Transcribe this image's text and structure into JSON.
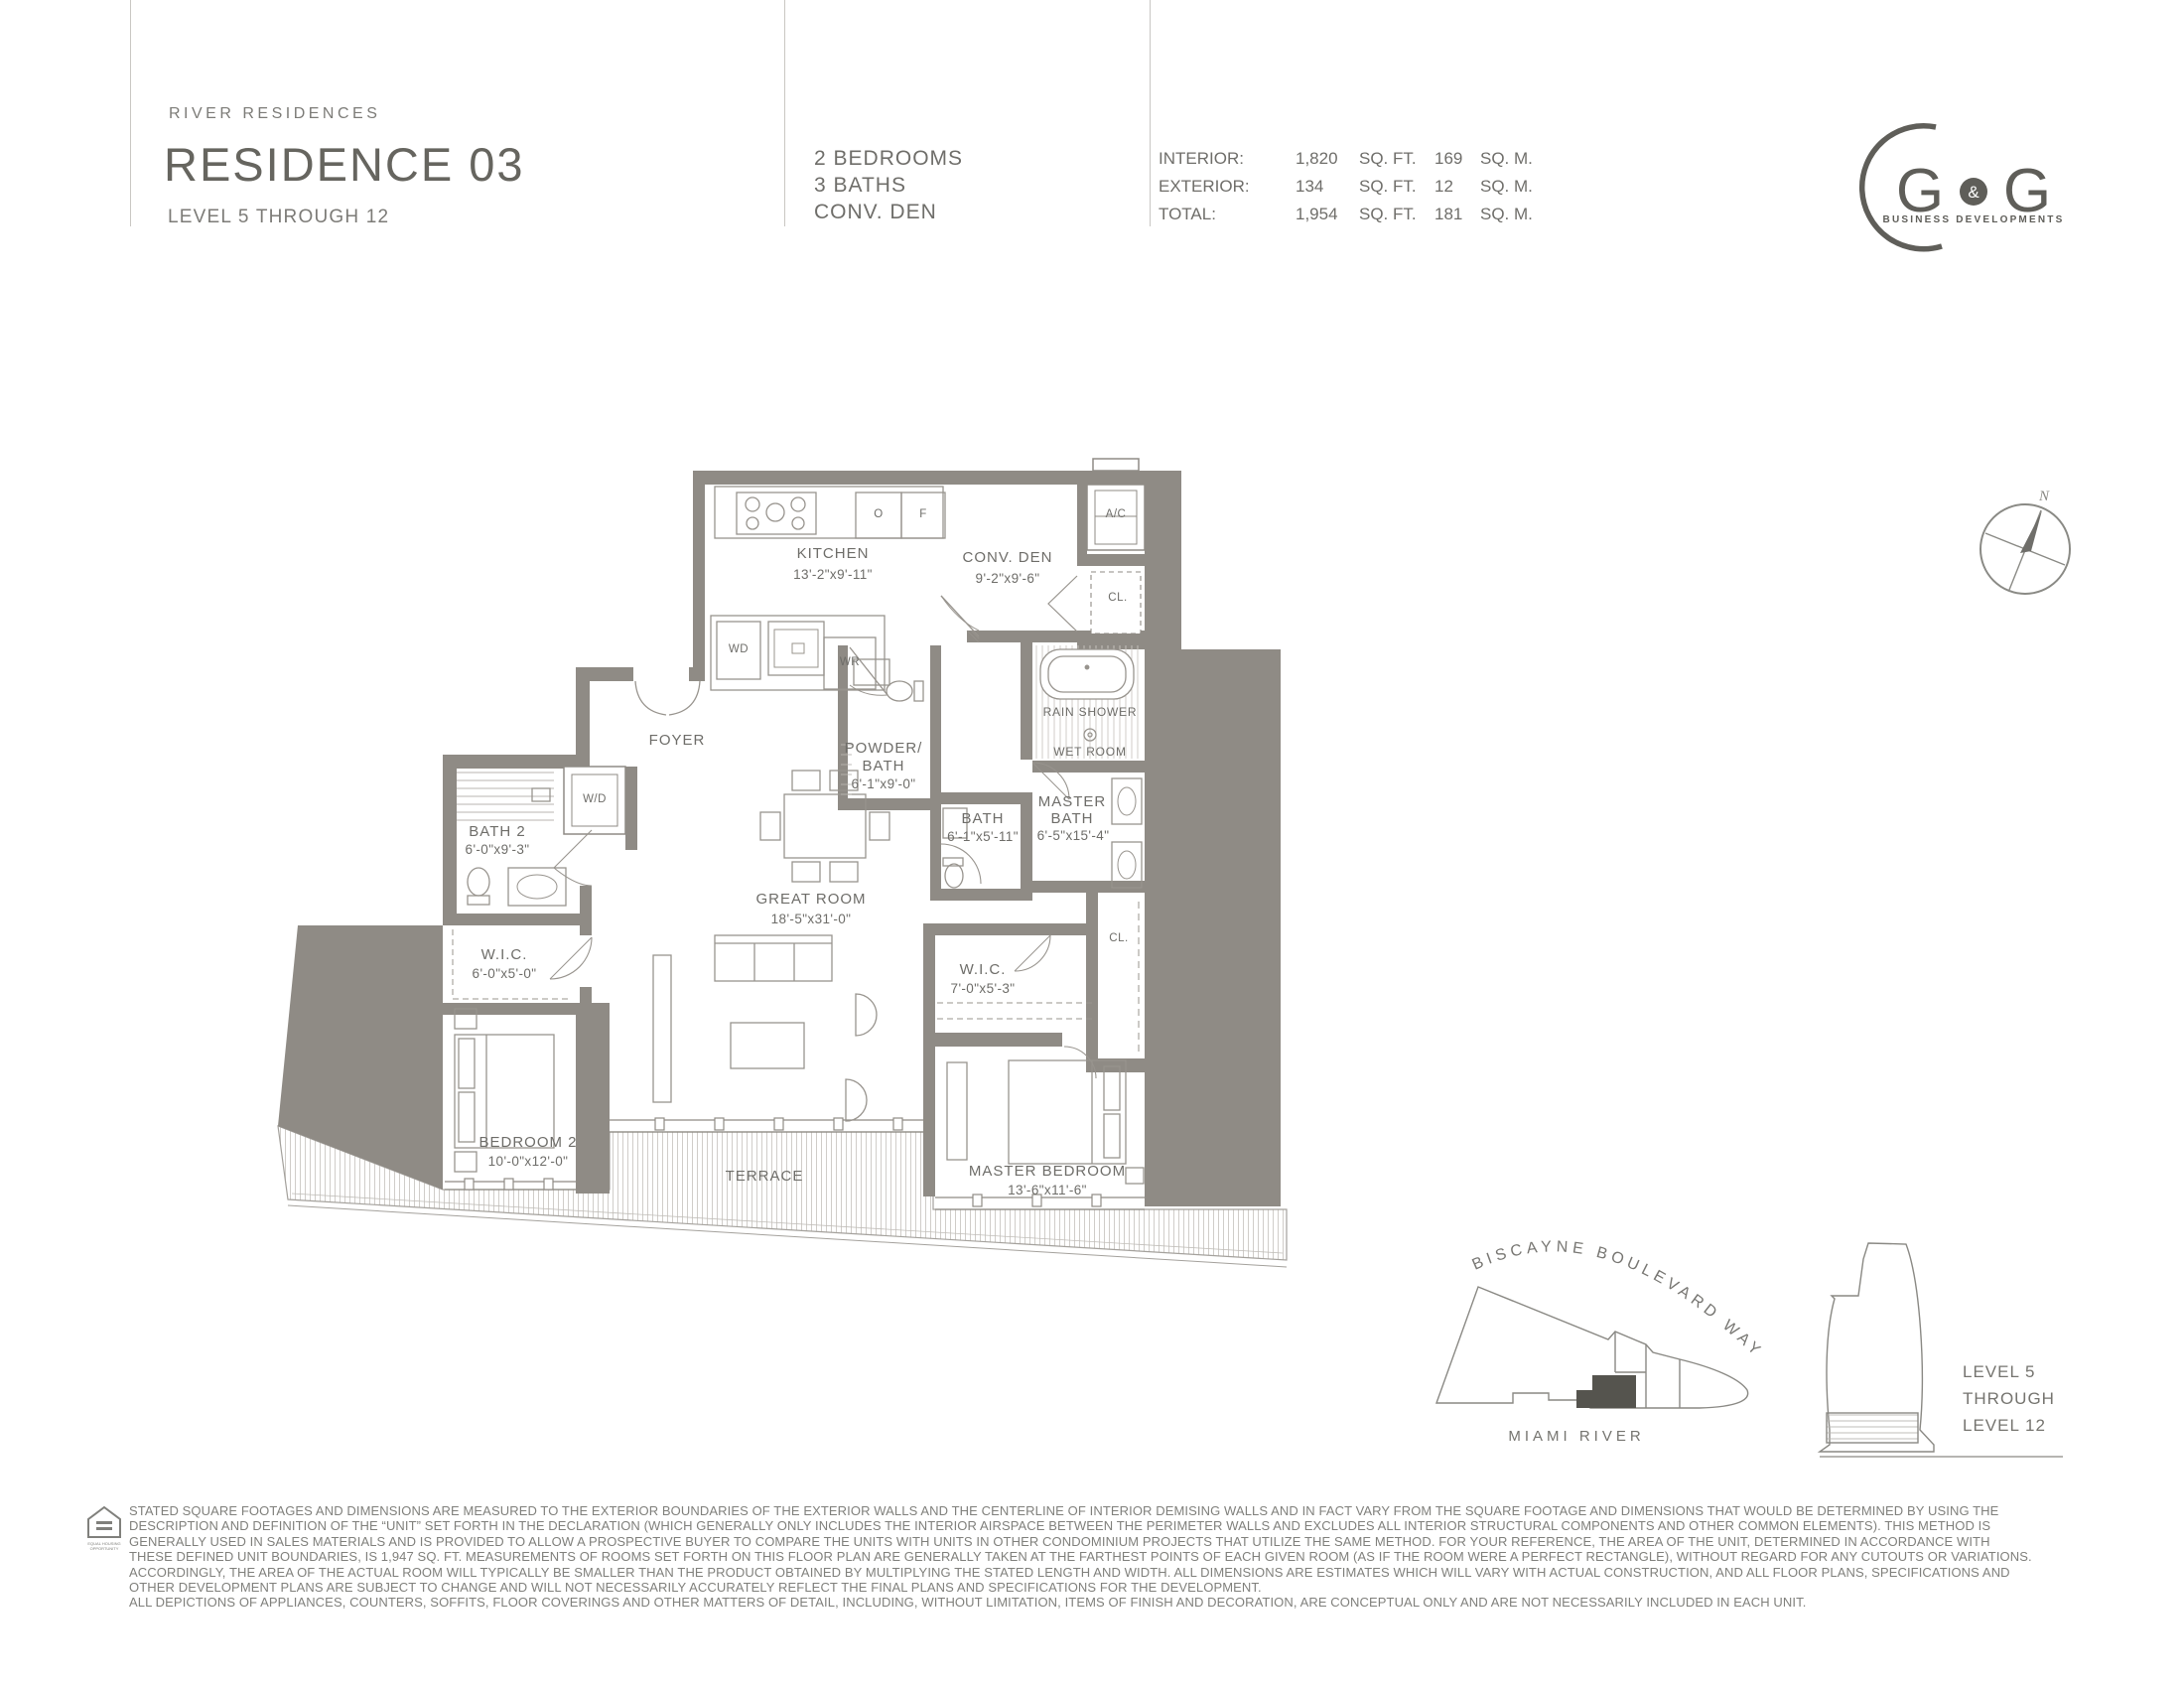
{
  "header": {
    "brand": "RIVER RESIDENCES",
    "title": "RESIDENCE 03",
    "subtitle": "LEVEL 5 THROUGH 12",
    "program_lines": [
      "2 BEDROOMS",
      "3 BATHS",
      "CONV. DEN"
    ],
    "stats_rows": [
      {
        "label": "INTERIOR:",
        "sqft_num": "1,820",
        "sqft_unit": "SQ. FT.",
        "sqm_num": "169",
        "sqm_unit": "SQ. M."
      },
      {
        "label": "EXTERIOR:",
        "sqft_num": "134",
        "sqft_unit": "SQ. FT.",
        "sqm_num": "12",
        "sqm_unit": "SQ. M."
      },
      {
        "label": "TOTAL:",
        "sqft_num": "1,954",
        "sqft_unit": "SQ. FT.",
        "sqm_num": "181",
        "sqm_unit": "SQ. M."
      }
    ]
  },
  "logo": {
    "g_left": "G",
    "ampersand": "&",
    "g_right": "G",
    "tagline": "BUSINESS DEVELOPMENTS"
  },
  "compass": {
    "north": "N"
  },
  "plan": {
    "kitchen": {
      "name": "KITCHEN",
      "dims": "13'-2\"x9'-11\""
    },
    "conv_den": {
      "name": "CONV. DEN",
      "dims": "9'-2\"x9'-6\""
    },
    "ac": "A/C",
    "cl_top": "CL.",
    "oven": "O",
    "fridge": "F",
    "wd_kitchen": "WD",
    "wr": "WR",
    "foyer": "FOYER",
    "wd_closet": "W/D",
    "bath2": {
      "name": "BATH 2",
      "dims": "6'-0\"x9'-3\""
    },
    "wic2": {
      "name": "W.I.C.",
      "dims": "6'-0\"x5'-0\""
    },
    "bedroom2": {
      "name": "BEDROOM 2",
      "dims": "10'-0\"x12'-0\""
    },
    "great_room": {
      "name": "GREAT ROOM",
      "dims": "18'-5\"x31'-0\""
    },
    "terrace": "TERRACE",
    "powder": {
      "line1": "POWDER/",
      "line2": "BATH",
      "dims": "6'-1\"x9'-0\""
    },
    "rain_shower": "RAIN SHOWER",
    "wet_room": "WET ROOM",
    "bath": {
      "name": "BATH",
      "dims": "6'-1\"x5'-11\""
    },
    "master_bath": {
      "line1": "MASTER",
      "line2": "BATH",
      "dims": "6'-5\"x15'-4\""
    },
    "cl_mid": "CL.",
    "wic_master": {
      "name": "W.I.C.",
      "dims": "7'-0\"x5'-3\""
    },
    "master_bedroom": {
      "name": "MASTER BEDROOM",
      "dims": "13'-6\"x11'-6\""
    }
  },
  "site_map": {
    "street": "BISCAYNE BOULEVARD WAY",
    "river": "MIAMI RIVER"
  },
  "building_key": {
    "lines": [
      "LEVEL 5",
      "THROUGH",
      "LEVEL 12"
    ]
  },
  "footer": {
    "lines": [
      "STATED SQUARE FOOTAGES AND DIMENSIONS ARE MEASURED TO THE EXTERIOR BOUNDARIES OF THE EXTERIOR WALLS AND THE CENTERLINE OF INTERIOR DEMISING WALLS AND IN FACT VARY FROM THE SQUARE FOOTAGE AND DIMENSIONS THAT WOULD BE DETERMINED BY USING THE",
      "DESCRIPTION AND DEFINITION OF THE “UNIT” SET FORTH IN THE DECLARATION (WHICH GENERALLY ONLY INCLUDES THE INTERIOR AIRSPACE BETWEEN THE PERIMETER WALLS AND EXCLUDES ALL INTERIOR STRUCTURAL COMPONENTS AND OTHER COMMON ELEMENTS). THIS METHOD IS",
      "GENERALLY USED IN SALES MATERIALS AND IS PROVIDED TO ALLOW A PROSPECTIVE BUYER TO COMPARE THE UNITS WITH UNITS IN OTHER CONDOMINIUM PROJECTS THAT UTILIZE THE SAME METHOD. FOR YOUR REFERENCE, THE AREA OF THE UNIT, DETERMINED IN ACCORDANCE WITH",
      "THESE DEFINED UNIT BOUNDARIES, IS 1,947 SQ. FT. MEASUREMENTS OF ROOMS SET FORTH ON THIS FLOOR PLAN ARE GENERALLY TAKEN AT THE FARTHEST POINTS OF EACH GIVEN ROOM (AS IF THE ROOM WERE A PERFECT RECTANGLE), WITHOUT REGARD FOR ANY CUTOUTS OR VARIATIONS.",
      "ACCORDINGLY, THE AREA OF THE ACTUAL ROOM WILL TYPICALLY BE SMALLER THAN THE PRODUCT OBTAINED BY MULTIPLYING THE STATED LENGTH AND WIDTH. ALL DIMENSIONS ARE ESTIMATES WHICH WILL VARY WITH ACTUAL CONSTRUCTION, AND ALL FLOOR PLANS, SPECIFICATIONS AND",
      "OTHER DEVELOPMENT PLANS ARE SUBJECT TO CHANGE AND WILL NOT NECESSARILY ACCURATELY REFLECT THE FINAL PLANS AND SPECIFICATIONS FOR THE DEVELOPMENT.",
      "ALL DEPICTIONS OF APPLIANCES, COUNTERS, SOFFITS, FLOOR COVERINGS AND OTHER MATTERS OF DETAIL, INCLUDING, WITHOUT LIMITATION, ITEMS OF FINISH AND DECORATION, ARE CONCEPTUAL ONLY AND ARE NOT NECESSARILY INCLUDED IN EACH UNIT."
    ]
  },
  "icons": {
    "equal_housing": "equal-housing-icon",
    "compass": "compass-icon",
    "logo_crescent": "gg-logo-crescent-icon"
  },
  "colors": {
    "wall_gray": "#8f8b85",
    "line_gray": "#98948e",
    "hatch_gray": "#cbc8c3",
    "text_gray": "#6e6d69",
    "dark_marker": "#55544e"
  }
}
